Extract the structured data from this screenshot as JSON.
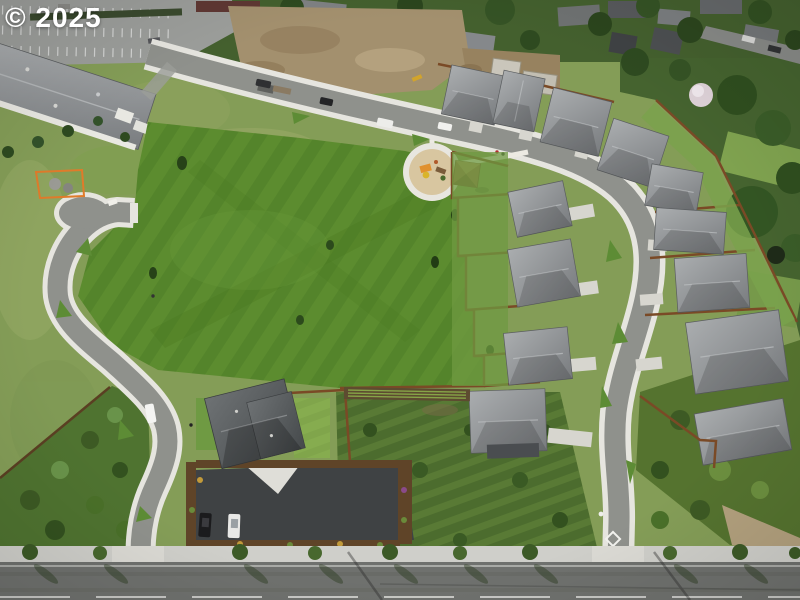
{
  "watermark": {
    "text": "© 2025"
  },
  "image": {
    "kind": "aerial-drone-photograph",
    "subject": "Aerial view of a new residential subdivision: large central park lawn, looping streets with white sidewalks, rows of gray-roofed new homes along the east side, circular playground with picnic shelter, model home with sales parking lot and two parked cars, construction dirt lots and an existing neighborhood to the north, school parking lot at upper left, arterial road along the bottom",
    "width_px": 800,
    "height_px": 600
  },
  "scene": {
    "areas": [
      "school-parking-lot-top-left",
      "school-building",
      "existing-neighborhood-north",
      "construction-dirt-lots",
      "central-park-field",
      "playground-circle",
      "picnic-shelter",
      "west-loop-street-with-knuckle",
      "east-loop-street",
      "inner-house-row",
      "outer-house-row",
      "model-home-and-sales-lot",
      "orchard-brush-block",
      "shrub-triangle-southwest",
      "hillside-brush-southeast",
      "arterial-road-south"
    ],
    "objects": [
      "white-van-on-street",
      "white-car-on-street",
      "dark-pickup-with-trailer",
      "black-parked-car",
      "white-parked-car",
      "street-trees",
      "utility-pole-shadows",
      "white-diamond-pavement-marking",
      "yellow-curb-markings",
      "orange-construction-fence",
      "garden-rows",
      "trampoline",
      "flowering-tree",
      "park-bench"
    ]
  },
  "palette": {
    "field_green": "#5c8c2f",
    "rough_grass": "#8ba55f",
    "dark_tree": "#2e4a1f",
    "new_asphalt_street": "#8f918c",
    "arterial_road": "#74767100",
    "sidewalk": "#e6e5df",
    "roof_gray_light": "#a9acae",
    "roof_gray_dark": "#55585a",
    "fence_brown": "#7a4a26",
    "dirt_tan": "#a3906e",
    "playground_surface": "#d8c6a0",
    "play_equipment_orange": "#e0912f",
    "sales_lot_asphalt": "#3f4244",
    "watermark_white": "#ffffff"
  }
}
